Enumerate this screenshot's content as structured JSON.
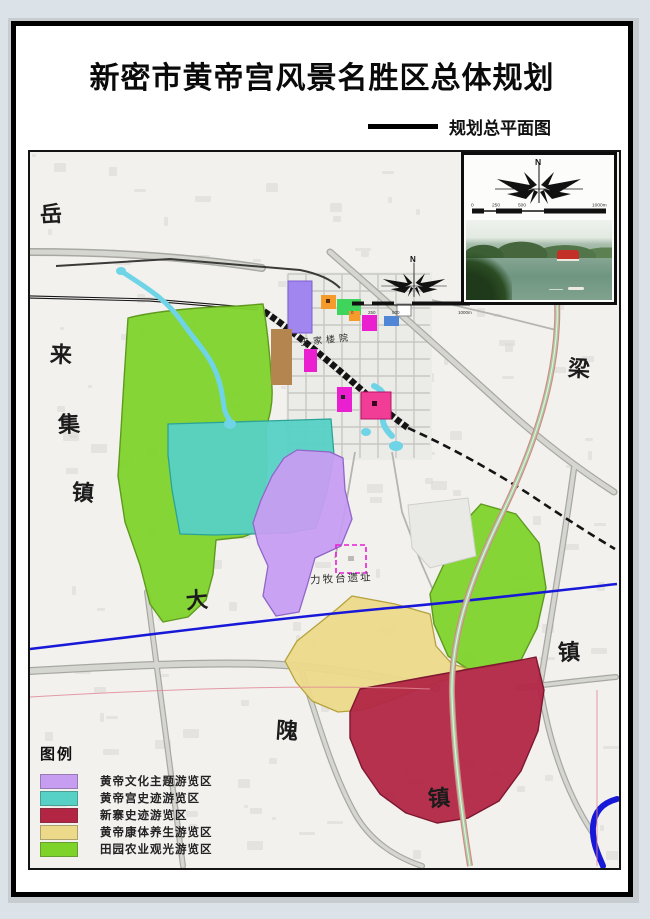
{
  "header": {
    "title": "新密市黄帝宫风景名胜区总体规划",
    "subtitle": "规划总平面图"
  },
  "compass": {
    "north": "N"
  },
  "scale_bar": {
    "ticks": [
      "0",
      "250",
      "500",
      "1000m"
    ]
  },
  "map_labels": {
    "towns": [
      {
        "text": "岳"
      },
      {
        "text": "来"
      },
      {
        "text": "集"
      },
      {
        "text": "镇"
      },
      {
        "text": "大"
      },
      {
        "text": "隗"
      },
      {
        "text": "镇"
      },
      {
        "text": "梁"
      },
      {
        "text": "镇"
      }
    ],
    "site": "力牧台遗址",
    "district": "王家楼院"
  },
  "legend": {
    "title": "图例",
    "items": [
      {
        "label": "黄帝文化主题游览区",
        "color": "#c79df2"
      },
      {
        "label": "黄帝宫史迹游览区",
        "color": "#57d1c5"
      },
      {
        "label": "新寨史迹游览区",
        "color": "#b22644"
      },
      {
        "label": "黄帝康体养生游览区",
        "color": "#ecd98a"
      },
      {
        "label": "田园农业观光游览区",
        "color": "#7ed32b"
      }
    ]
  },
  "colors": {
    "river": "#1818d8",
    "stream": "#6fd4e6",
    "expressway_green": "#a6cfa2",
    "expressway_red": "#d88486",
    "railway": "#141414"
  }
}
